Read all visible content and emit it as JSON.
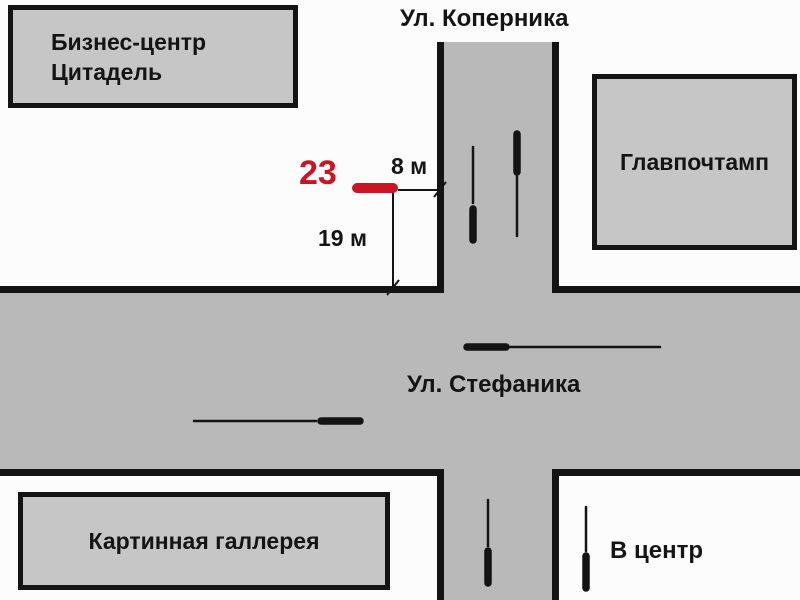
{
  "colors": {
    "street_fill": "#b9b9b9",
    "building_fill": "#c6c6c6",
    "outline": "#141414",
    "marker_red": "#cc1522",
    "background": "#fcfcfc"
  },
  "streets": {
    "kopernika": {
      "label": "Ул. Коперника"
    },
    "stefanika": {
      "label": "Ул. Стефаника"
    }
  },
  "buildings": {
    "business_center": {
      "line1": "Бизнес-центр",
      "line2": "Цитадель"
    },
    "post_office": {
      "label": "Главпочтамп"
    },
    "art_gallery": {
      "label": "Картинная галлерея"
    }
  },
  "marker": {
    "number": "23"
  },
  "measurements": {
    "offset_from_road": "8 м",
    "offset_from_intersection": "19 м"
  },
  "legend": {
    "to_center": "В центр"
  }
}
